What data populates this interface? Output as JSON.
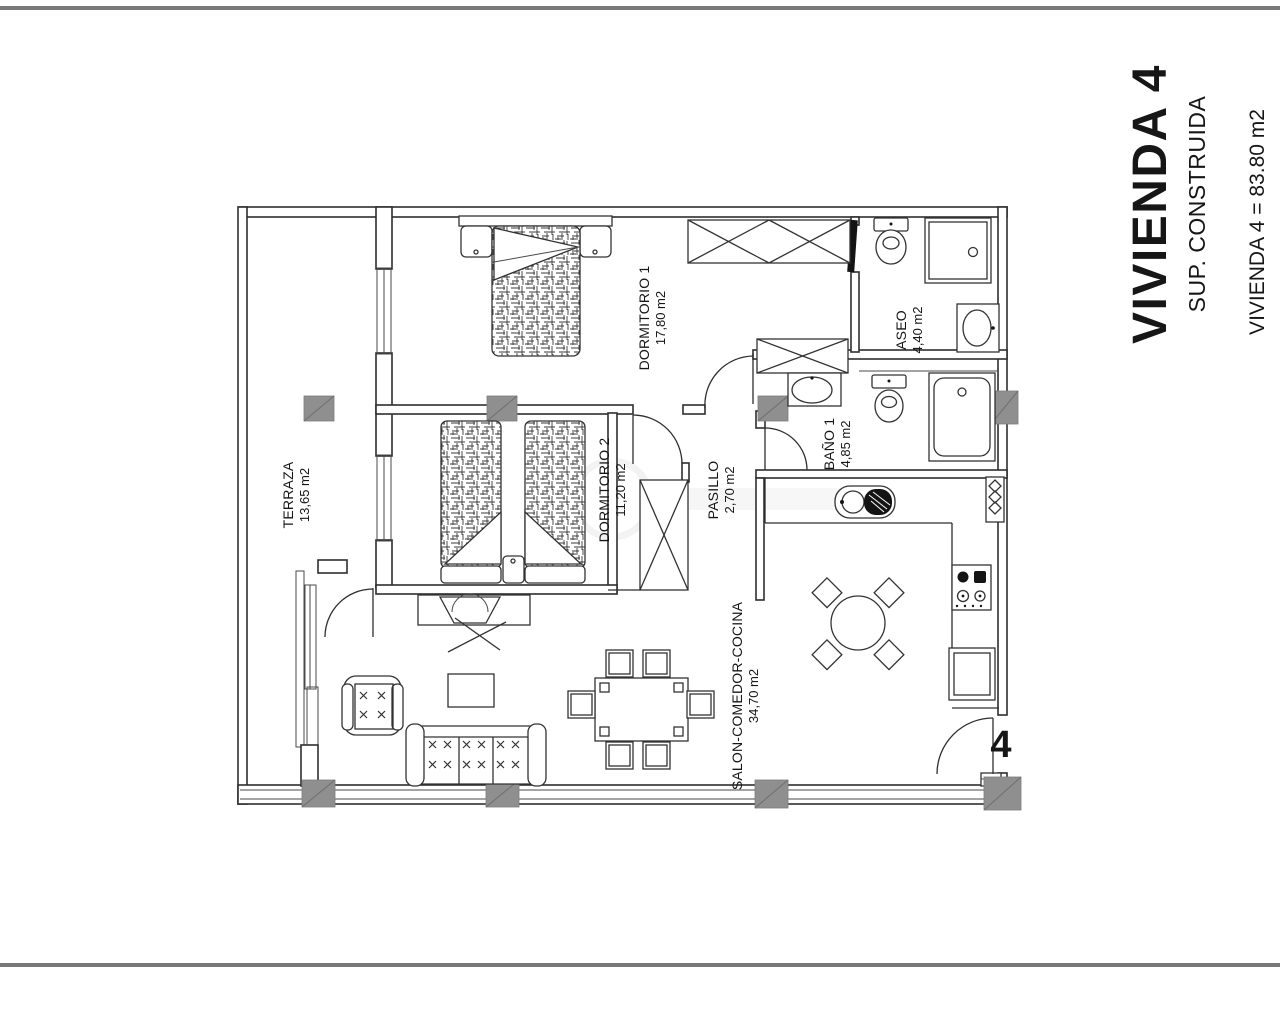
{
  "page": {
    "background_color": "#ffffff",
    "divider_color": "#787878"
  },
  "title_block": {
    "title": "VIVIENDA 4",
    "subtitle": "SUP. CONSTRUIDA",
    "area_line": "VIVIENDA 4 = 83.80 m2"
  },
  "floor_plan": {
    "unit_number": "4",
    "line_color": "#2e2e2e",
    "column_color": "#8f8f8f",
    "rooms": [
      {
        "id": "terraza",
        "name": "TERRAZA",
        "area": "13,65 m2"
      },
      {
        "id": "dormitorio-1",
        "name": "DORMITORIO 1",
        "area": "17,80 m2"
      },
      {
        "id": "dormitorio-2",
        "name": "DORMITORIO 2",
        "area": "11,20 m2"
      },
      {
        "id": "pasillo",
        "name": "PASILLO",
        "area": "2,70 m2"
      },
      {
        "id": "aseo",
        "name": "ASEO",
        "area": "4,40 m2"
      },
      {
        "id": "bano-1",
        "name": "BAÑO 1",
        "area": "4,85 m2"
      },
      {
        "id": "salon-comedor-cocina",
        "name": "SALON-COMEDOR-COCINA",
        "area": "34,70 m2"
      }
    ]
  }
}
